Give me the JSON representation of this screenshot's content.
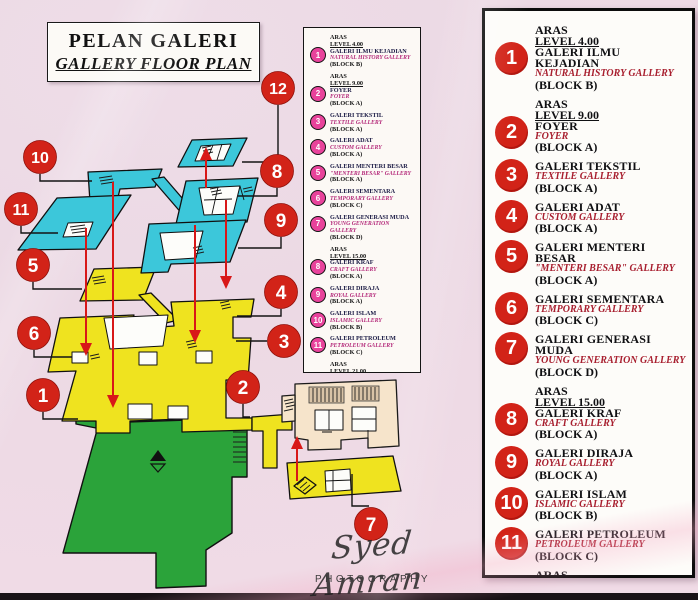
{
  "title": {
    "line1": "PELAN GALERI",
    "line2": "GALLERY FLOOR PLAN"
  },
  "photographer": {
    "signature": "Syed Amran",
    "label": "PHOTOGRAPHY"
  },
  "legend_entries": [
    {
      "num": "1",
      "aras": "ARAS",
      "level": "LEVEL 4.00",
      "name": "GALERI ILMU KEJADIAN",
      "name_en": "NATURAL HISTORY GALLERY",
      "block": "(BLOCK B)"
    },
    {
      "num": "2",
      "aras": "ARAS",
      "level": "LEVEL 9.00",
      "name": "FOYER",
      "name_en": "FOYER",
      "block": "(BLOCK A)"
    },
    {
      "num": "3",
      "name": "GALERI TEKSTIL",
      "name_en": "TEXTILE GALLERY",
      "block": "(BLOCK A)"
    },
    {
      "num": "4",
      "name": "GALERI ADAT",
      "name_en": "CUSTOM GALLERY",
      "block": "(BLOCK A)"
    },
    {
      "num": "5",
      "name": "GALERI MENTERI BESAR",
      "name_en": "\"MENTERI BESAR\" GALLERY",
      "block": "(BLOCK A)"
    },
    {
      "num": "6",
      "name": "GALERI SEMENTARA",
      "name_en": "TEMPORARY GALLERY",
      "block": "(BLOCK C)"
    },
    {
      "num": "7",
      "name": "GALERI GENERASI MUDA",
      "name_en": "YOUNG GENERATION GALLERY",
      "block": "(BLOCK D)"
    },
    {
      "num": "8",
      "aras": "ARAS",
      "level": "LEVEL 15.00",
      "name": "GALERI KRAF",
      "name_en": "CRAFT GALLERY",
      "block": "(BLOCK A)"
    },
    {
      "num": "9",
      "name": "GALERI DIRAJA",
      "name_en": "ROYAL GALLERY",
      "block": "(BLOCK A)"
    },
    {
      "num": "10",
      "name": "GALERI ISLAM",
      "name_en": "ISLAMIC GALLERY",
      "block": "(BLOCK B)"
    },
    {
      "num": "11",
      "name": "GALERI PETROLEUM",
      "name_en": "PETROLEUM GALLERY",
      "block": "(BLOCK C)"
    },
    {
      "num": "12",
      "aras": "ARAS",
      "level": "LEVEL 21.00",
      "name": "GALERI SEJARAH",
      "name_en": "HISTORY GALLERY",
      "block": "(BLOCK A)"
    }
  ],
  "plan_markers": [
    "1",
    "2",
    "3",
    "4",
    "5",
    "6",
    "7",
    "8",
    "9",
    "10",
    "11",
    "12"
  ],
  "colors": {
    "red": "#d22318",
    "pink": "#e8439b",
    "cyan": "#3cc7da",
    "yellow": "#efe31f",
    "green": "#2ba33a",
    "cream": "#f6e4cb",
    "crimson": "#a81f2f",
    "arrow": "#d81818"
  }
}
